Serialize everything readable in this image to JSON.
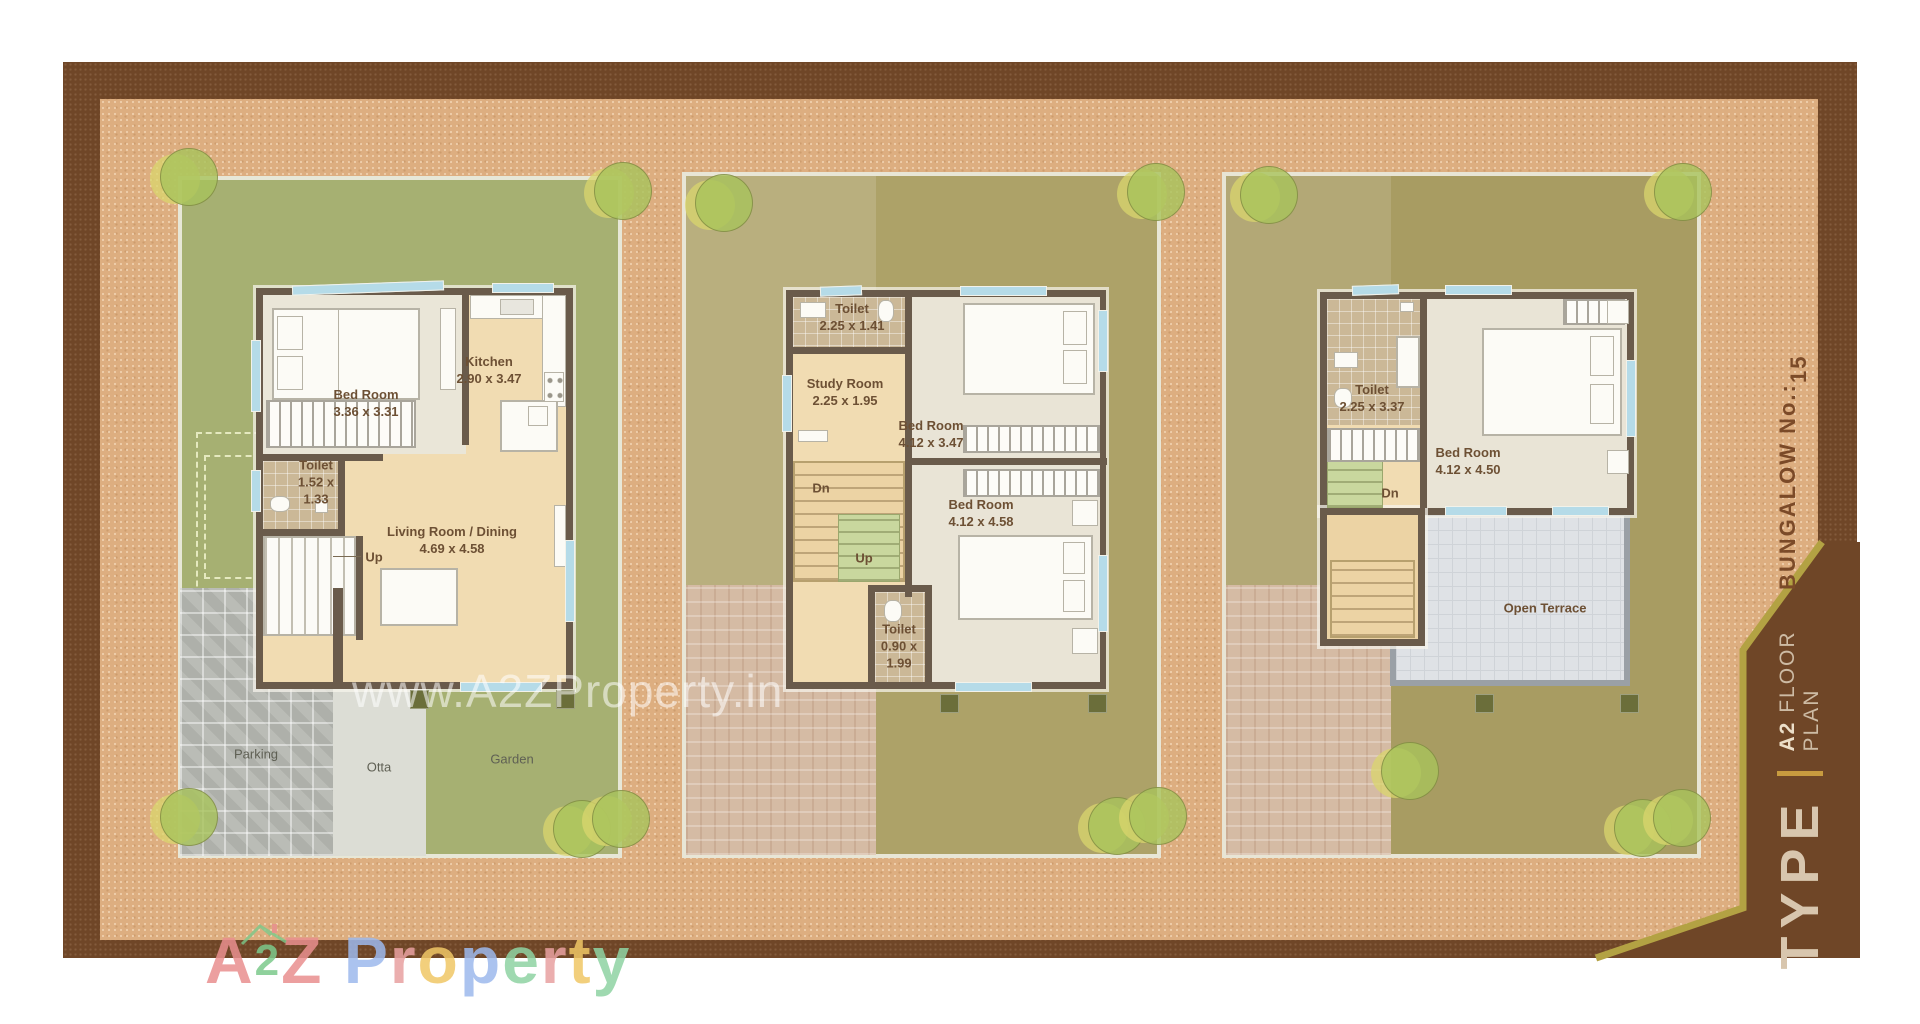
{
  "plot_plans": {
    "ground": {
      "bed_room": {
        "name": "Bed Room",
        "dims": "3.36 x 3.31"
      },
      "kitchen": {
        "name": "Kitchen",
        "dims": "2.90 x 3.47"
      },
      "toilet": {
        "name": "Toilet",
        "dims_l1": "1.52 x",
        "dims_l2": "1.33"
      },
      "living": {
        "name": "Living Room / Dining",
        "dims": "4.69 x 4.58"
      },
      "stairs_up": "Up",
      "parking": "Parking",
      "otta": "Otta",
      "garden": "Garden"
    },
    "first": {
      "toilet_top": {
        "name": "Toilet",
        "dims": "2.25 x 1.41"
      },
      "study": {
        "name": "Study Room",
        "dims": "2.25 x 1.95"
      },
      "bed_room_1": {
        "name": "Bed Room",
        "dims": "4.12 x 3.47"
      },
      "bed_room_2": {
        "name": "Bed Room",
        "dims": "4.12 x 4.58"
      },
      "toilet_bottom": {
        "name": "Toilet",
        "dims_l1": "0.90 x",
        "dims_l2": "1.99"
      },
      "stairs_dn": "Dn",
      "stairs_up": "Up"
    },
    "second": {
      "toilet": {
        "name": "Toilet",
        "dims": "2.25 x 3.37"
      },
      "bed_room": {
        "name": "Bed Room",
        "dims": "4.12 x 4.50"
      },
      "open_terrace": "Open Terrace",
      "stairs_dn": "Dn"
    }
  },
  "sidebar": {
    "bungalow_label": "BUNGALOW No.:",
    "bungalow_number": "15",
    "type_word": "TYPE",
    "floor_code": "A2",
    "floor_word": "FLOOR",
    "plan_word": "PLAN"
  },
  "watermarks": {
    "center": "www.A2ZProperty.in",
    "bottom_letters": [
      {
        "ch": "A",
        "color": "#e98f8f"
      },
      {
        "ch": "2",
        "color": "#7cc98b",
        "small": true
      },
      {
        "ch": "Z",
        "color": "#e98f8f"
      },
      {
        "ch": " "
      },
      {
        "ch": "P",
        "color": "#9db9ed"
      },
      {
        "ch": "r",
        "color": "#e8a1a1"
      },
      {
        "ch": "o",
        "color": "#f0c766"
      },
      {
        "ch": "p",
        "color": "#9db9ed"
      },
      {
        "ch": "e",
        "color": "#8fd3a3"
      },
      {
        "ch": "r",
        "color": "#e8a1a1"
      },
      {
        "ch": "t",
        "color": "#f0c766"
      },
      {
        "ch": "y",
        "color": "#8fd3a3"
      }
    ]
  },
  "colors": {
    "frame_brown": "#6F4627",
    "ground_tan": "#DDAE80",
    "plot_green": "#A6B072",
    "plot_olive": "#ADA268",
    "plot_khaki": "#A89C62",
    "wall": "#6A5B4B",
    "divider_gold": "#C89B3F",
    "label_brown": "#6D5034"
  }
}
